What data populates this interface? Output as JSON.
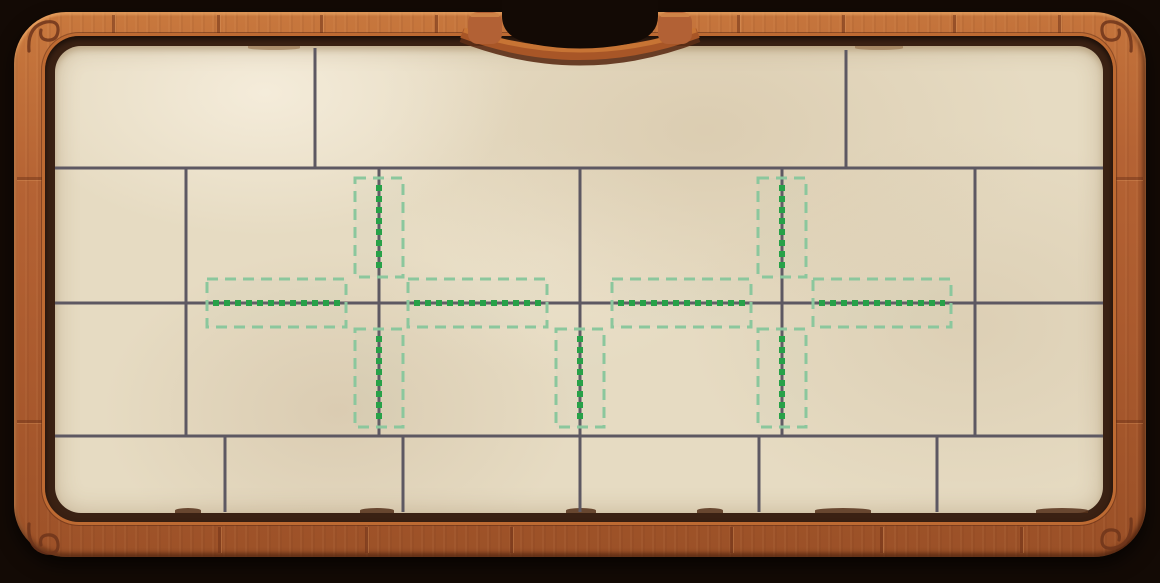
{
  "scene": "wooden-frame-puzzle-board",
  "colors": {
    "background": "#130a05",
    "wood_light": "#c9793e",
    "wood_mid": "#aa5a2e",
    "wood_dark": "#9a5027",
    "wood_lip": "#3a2113",
    "wood_rim": "#bd6a32",
    "paper": "#e6dbc2",
    "grid_line": "#5d5862",
    "zone_border": "#8bc79d",
    "stitch_green": "#27a148"
  },
  "board": {
    "paper_rect": {
      "x": 55,
      "y": 46,
      "w": 1048,
      "h": 467
    },
    "h_lines": [
      {
        "y": 168,
        "x1": 55,
        "x2": 1103
      },
      {
        "y": 303,
        "x1": 55,
        "x2": 1103
      },
      {
        "y": 436,
        "x1": 55,
        "x2": 1103
      }
    ],
    "v_lines": [
      {
        "x": 315,
        "y1": 48,
        "y2": 168
      },
      {
        "x": 846,
        "y1": 50,
        "y2": 168
      },
      {
        "x": 186,
        "y1": 168,
        "y2": 436
      },
      {
        "x": 379,
        "y1": 168,
        "y2": 436
      },
      {
        "x": 580,
        "y1": 168,
        "y2": 436
      },
      {
        "x": 782,
        "y1": 168,
        "y2": 436
      },
      {
        "x": 975,
        "y1": 168,
        "y2": 436
      },
      {
        "x": 225,
        "y1": 436,
        "y2": 512
      },
      {
        "x": 403,
        "y1": 436,
        "y2": 512
      },
      {
        "x": 580,
        "y1": 436,
        "y2": 512
      },
      {
        "x": 759,
        "y1": 436,
        "y2": 512
      },
      {
        "x": 937,
        "y1": 436,
        "y2": 512
      }
    ]
  },
  "zones": [
    {
      "id": "left-cross-north",
      "x": 355,
      "y": 178,
      "w": 48,
      "h": 99,
      "dir": "v"
    },
    {
      "id": "left-cross-west",
      "x": 207,
      "y": 279,
      "w": 139,
      "h": 48,
      "dir": "h"
    },
    {
      "id": "left-cross-east",
      "x": 408,
      "y": 279,
      "w": 139,
      "h": 48,
      "dir": "h"
    },
    {
      "id": "left-cross-south",
      "x": 355,
      "y": 329,
      "w": 48,
      "h": 98,
      "dir": "v"
    },
    {
      "id": "center-south",
      "x": 556,
      "y": 329,
      "w": 48,
      "h": 98,
      "dir": "v"
    },
    {
      "id": "right-cross-north",
      "x": 758,
      "y": 178,
      "w": 48,
      "h": 99,
      "dir": "v"
    },
    {
      "id": "right-cross-west",
      "x": 612,
      "y": 279,
      "w": 139,
      "h": 48,
      "dir": "h"
    },
    {
      "id": "right-cross-east",
      "x": 813,
      "y": 279,
      "w": 138,
      "h": 48,
      "dir": "h"
    },
    {
      "id": "right-cross-south",
      "x": 758,
      "y": 329,
      "w": 48,
      "h": 98,
      "dir": "v"
    }
  ],
  "frame_decor": {
    "top_seams": [
      112,
      217,
      320,
      435,
      737,
      842,
      953,
      1058
    ],
    "bottom_seams": [
      218,
      365,
      510,
      730,
      880,
      1020
    ],
    "side_seams": [
      177,
      420
    ],
    "paper_curls_bottom": [
      {
        "x": 175,
        "w": 26
      },
      {
        "x": 360,
        "w": 34
      },
      {
        "x": 566,
        "w": 30
      },
      {
        "x": 697,
        "w": 26
      },
      {
        "x": 815,
        "w": 56
      },
      {
        "x": 1036,
        "w": 52
      }
    ],
    "paper_curls_top": [
      {
        "x": 248,
        "w": 52
      },
      {
        "x": 855,
        "w": 48
      }
    ]
  }
}
